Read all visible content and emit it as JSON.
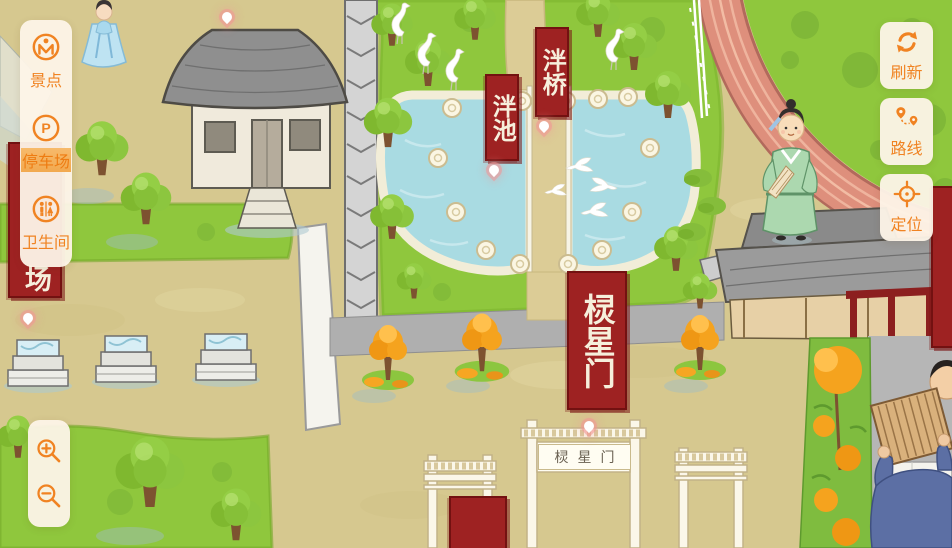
{
  "ui": {
    "left_panel": {
      "items": [
        {
          "id": "scenic",
          "label": "景点"
        },
        {
          "id": "parking",
          "label": "停车场",
          "highlighted": true
        },
        {
          "id": "restroom",
          "label": "卫生间"
        }
      ]
    },
    "right_panel": {
      "items": [
        {
          "id": "refresh",
          "label": "刷新"
        },
        {
          "id": "route",
          "label": "路线"
        },
        {
          "id": "locate",
          "label": "定位"
        }
      ]
    },
    "icons": {
      "parking_glyph": "P"
    }
  },
  "map": {
    "banners": {
      "pan_bridge": "泮桥",
      "pan_pond": "泮池",
      "lingxing_gate": "棂星门",
      "parking_partial": "场"
    },
    "gate_plaque": "棂星门",
    "colors": {
      "accent": "#F08322",
      "banner_red": "#9E2222",
      "pond_blue": "#A9DBE2",
      "grass_green": "#8FC73D",
      "ground_tan": "#D6C88F",
      "track_salmon": "#DE8F7C"
    }
  }
}
